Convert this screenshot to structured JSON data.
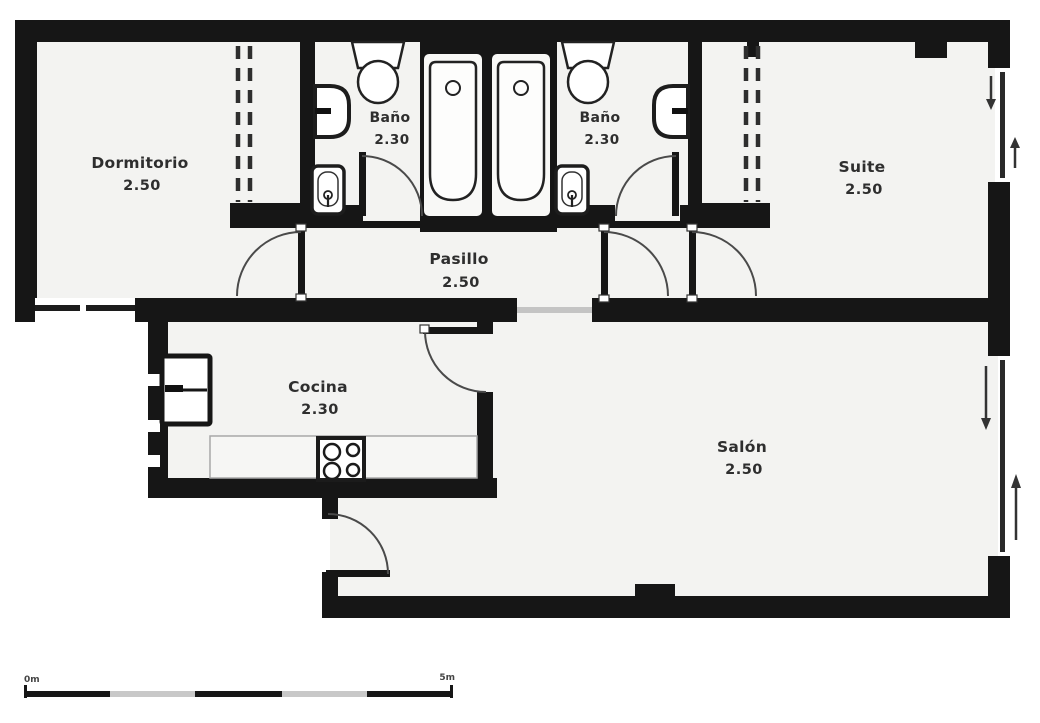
{
  "title": "Apartment floor plan",
  "rooms": {
    "dormitorio": {
      "name": "Dormitorio",
      "dimension": "2.50"
    },
    "bano1": {
      "name": "Baño",
      "dimension": "2.30"
    },
    "bano2": {
      "name": "Baño",
      "dimension": "2.30"
    },
    "suite": {
      "name": "Suite",
      "dimension": "2.50"
    },
    "pasillo": {
      "name": "Pasillo",
      "dimension": "2.50"
    },
    "cocina": {
      "name": "Cocina",
      "dimension": "2.30"
    },
    "salon": {
      "name": "Salón",
      "dimension": "2.50"
    }
  },
  "scale_bar": {
    "start_label": "0m",
    "end_label": "5m"
  },
  "colors": {
    "wall": "#161616",
    "room_fill": "#f3f3f1",
    "background": "#ffffff",
    "fixture_outline": "#1d1d1d",
    "arc": "#4a4a4a",
    "threshold": "#c4c4c4"
  },
  "fixtures": [
    "toilet-icon",
    "sink-icon",
    "bidet-icon",
    "bathtub-icon",
    "fridge-icon",
    "stove-icon",
    "counter",
    "door-arc",
    "closet-dashed-front",
    "sliding-window-arrow",
    "scale-bar"
  ]
}
